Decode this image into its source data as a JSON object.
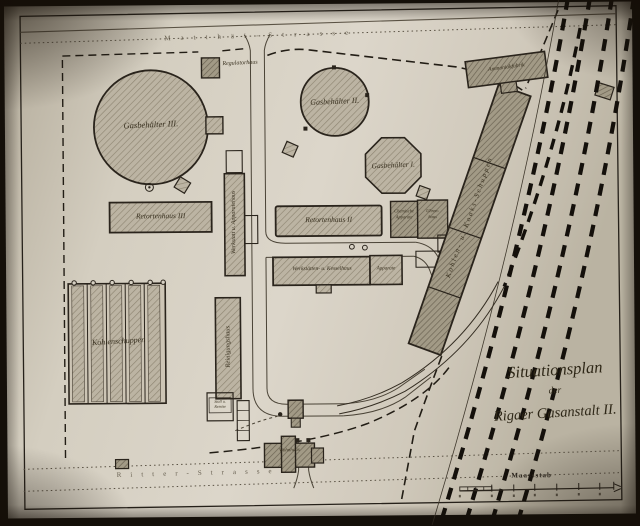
{
  "plan": {
    "title": {
      "line1": "Situationsplan",
      "line2": "der",
      "line3": "Rigaer Gasanstalt II."
    },
    "streets": {
      "top": "Matthäi-Strasse",
      "bottom": "Ritter-Strasse"
    },
    "scale_label": "Maassstab",
    "buildings": {
      "gasbehaelter3": "Gasbehälter III.",
      "gasbehaelter2": "Gasbehälter II.",
      "gasbehaelter1": "Gasbehälter I.",
      "retortenhaus3": "Retortenhaus III",
      "retortenhaus2": "Retortenhaus II",
      "chemische_line1": "Chemische",
      "chemische_line2": "Apparate",
      "uhrenhaus_line1": "Uhren-",
      "uhrenhaus_line2": "haus",
      "werkstaetten": "Werkstätten- u. Kesselhaus",
      "anbau": "Apparate",
      "apparatehaus": "Werkstatt u. Apparatehaus",
      "reinigungshaus": "Reinigungshaus",
      "kohlenschuppen": "Kohlenschuppen",
      "koksschuppen": "Kohlen- u. Koaks-Schuppen",
      "ammoniakfabrik": "Ammoniakfabrik",
      "regulatorhaus": "Regulatorhaus",
      "wohnhaus": "Wohnhaus",
      "stall_line1": "Stall u.",
      "stall_line2": "Remise"
    },
    "colors": {
      "paper": "#d6d0c3",
      "ink": "#2a241c",
      "building_light": "#bcb4a3",
      "building_dark": "#a29a86"
    }
  }
}
